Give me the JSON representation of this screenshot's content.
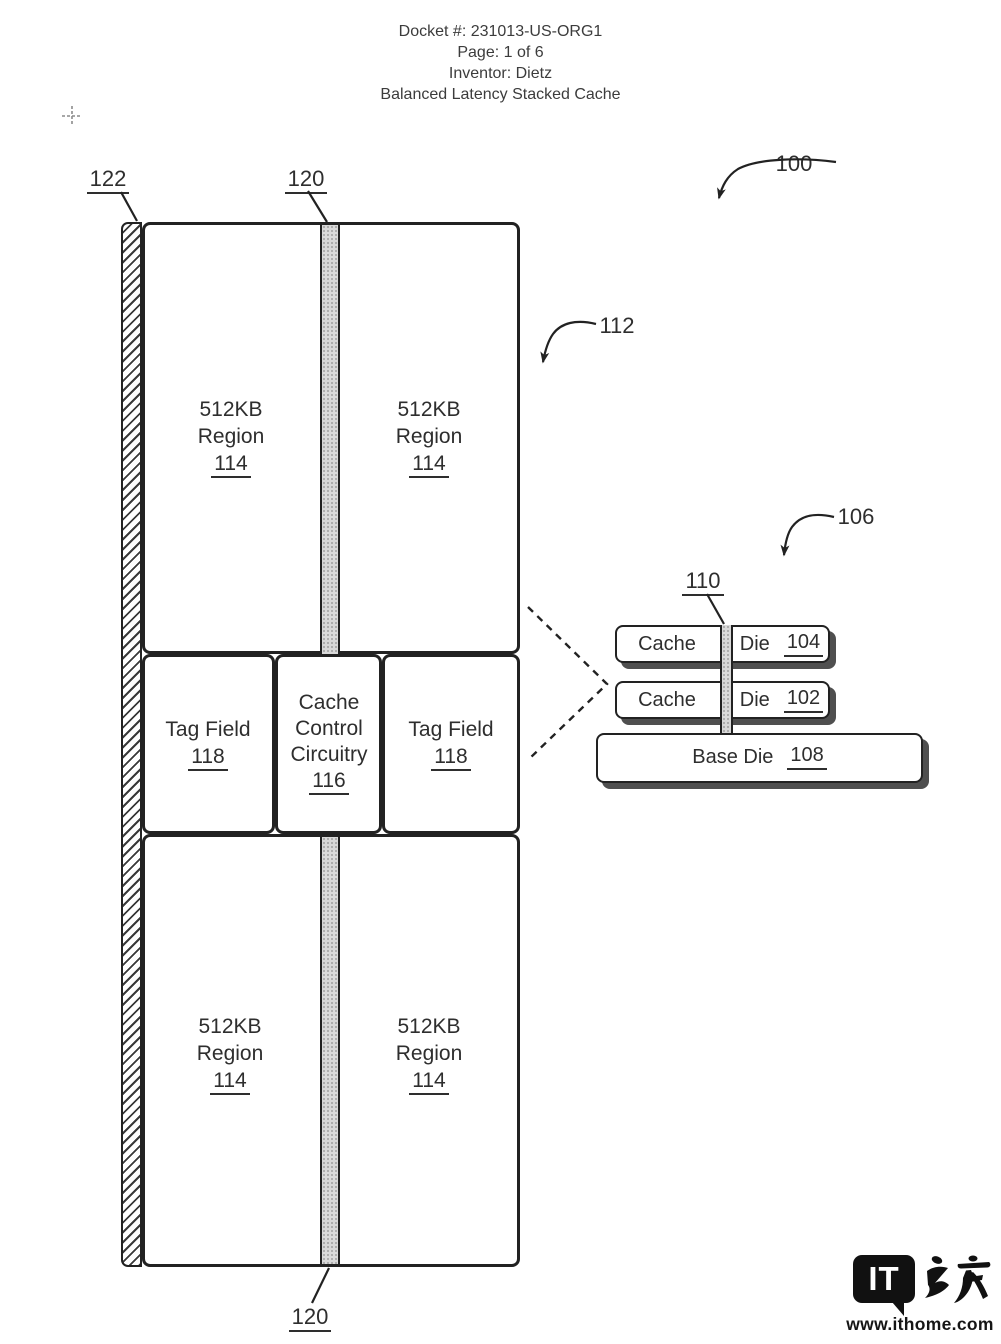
{
  "page_header": {
    "docket": "Docket #: 231013-US-ORG1",
    "page": "Page: 1 of 6",
    "inventor": "Inventor: Dietz",
    "title": "Balanced Latency Stacked Cache"
  },
  "figure": {
    "refs": {
      "overall": "100",
      "cache_die_layout": "112",
      "stack": "106",
      "tsv_column": "110",
      "edge_strip": "122",
      "bus_top": "120",
      "bus_bottom": "120"
    },
    "layout": {
      "regions": [
        {
          "size": "512KB",
          "name": "Region",
          "ref": "114"
        },
        {
          "size": "512KB",
          "name": "Region",
          "ref": "114"
        },
        {
          "size": "512KB",
          "name": "Region",
          "ref": "114"
        },
        {
          "size": "512KB",
          "name": "Region",
          "ref": "114"
        }
      ],
      "tag_field_left": {
        "label": "Tag Field",
        "ref": "118"
      },
      "tag_field_right": {
        "label": "Tag Field",
        "ref": "118"
      },
      "control": {
        "line1": "Cache",
        "line2": "Control",
        "line3": "Circuitry",
        "ref": "116"
      }
    },
    "stack": {
      "die_top": {
        "cache": "Cache",
        "die": "Die",
        "ref": "104"
      },
      "die_bottom": {
        "cache": "Cache",
        "die": "Die",
        "ref": "102"
      },
      "base": {
        "label": "Base Die",
        "ref": "108"
      }
    }
  },
  "watermark": {
    "logo": "IT",
    "logo_cjk": "之家",
    "url": "www.ithome.com"
  },
  "colors": {
    "line": "#222222",
    "text": "#2e2e2e",
    "bus_fill": "#d9d9d9",
    "shadow": "#4f4f4f",
    "watermark": "#111111"
  }
}
